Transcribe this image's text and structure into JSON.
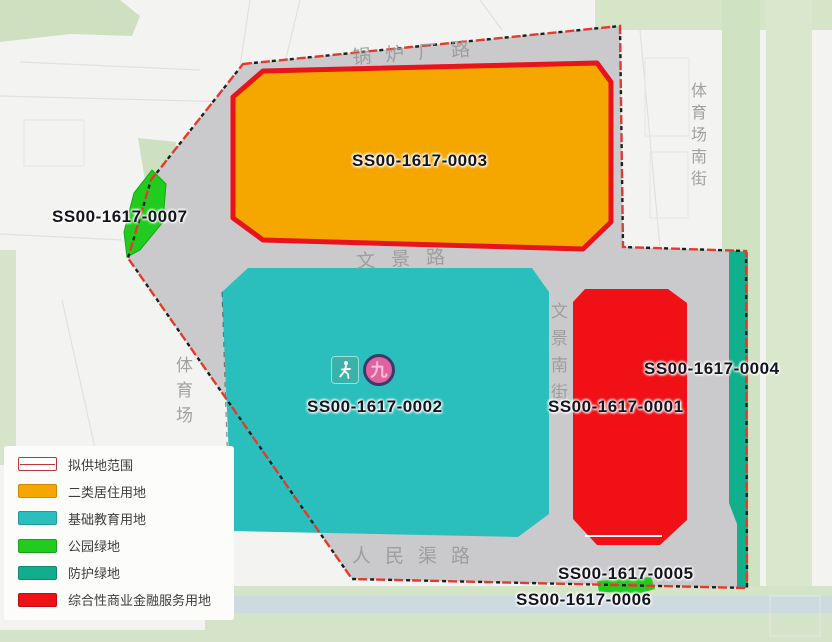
{
  "parcels": {
    "p0001": "SS00-1617-0001",
    "p0002": "SS00-1617-0002",
    "p0003": "SS00-1617-0003",
    "p0004": "SS00-1617-0004",
    "p0005": "SS00-1617-0005",
    "p0006": "SS00-1617-0006",
    "p0007": "SS00-1617-0007"
  },
  "roads": {
    "boiler_plant_road": "锅炉厂路",
    "wenjing_road": "文景路",
    "renmin_canal_road": "人民渠路",
    "wenjing_south_street": "文景南街",
    "stadium": "体育场",
    "stadium_south_street": "体育场南街"
  },
  "badges": {
    "school_number": "九"
  },
  "legend": {
    "items": [
      {
        "label": "拟供地范围",
        "swatch": "boundary",
        "color": "#C23434"
      },
      {
        "label": "二类居住用地",
        "swatch": "fill",
        "color": "#F5A700"
      },
      {
        "label": "基础教育用地",
        "swatch": "fill",
        "color": "#2ABFBD"
      },
      {
        "label": "公园绿地",
        "swatch": "fill",
        "color": "#21CC1E"
      },
      {
        "label": "防护绿地",
        "swatch": "fill",
        "color": "#12AE8C"
      },
      {
        "label": "综合性商业金融服务用地",
        "swatch": "fill",
        "color": "#F01016"
      }
    ]
  },
  "colors": {
    "site_interior_gray": "#CACACC",
    "residential_orange": "#F5A700",
    "residential_border_red": "#E8131B",
    "education_teal": "#2ABFBD",
    "commercial_red": "#F01016",
    "park_green": "#21CC1E",
    "protective_teal_green": "#12AE8C",
    "boundary_red": "#E23B2E",
    "basemap_green": "#D2E2C4",
    "road_text_gray": "#9B9B9B"
  }
}
